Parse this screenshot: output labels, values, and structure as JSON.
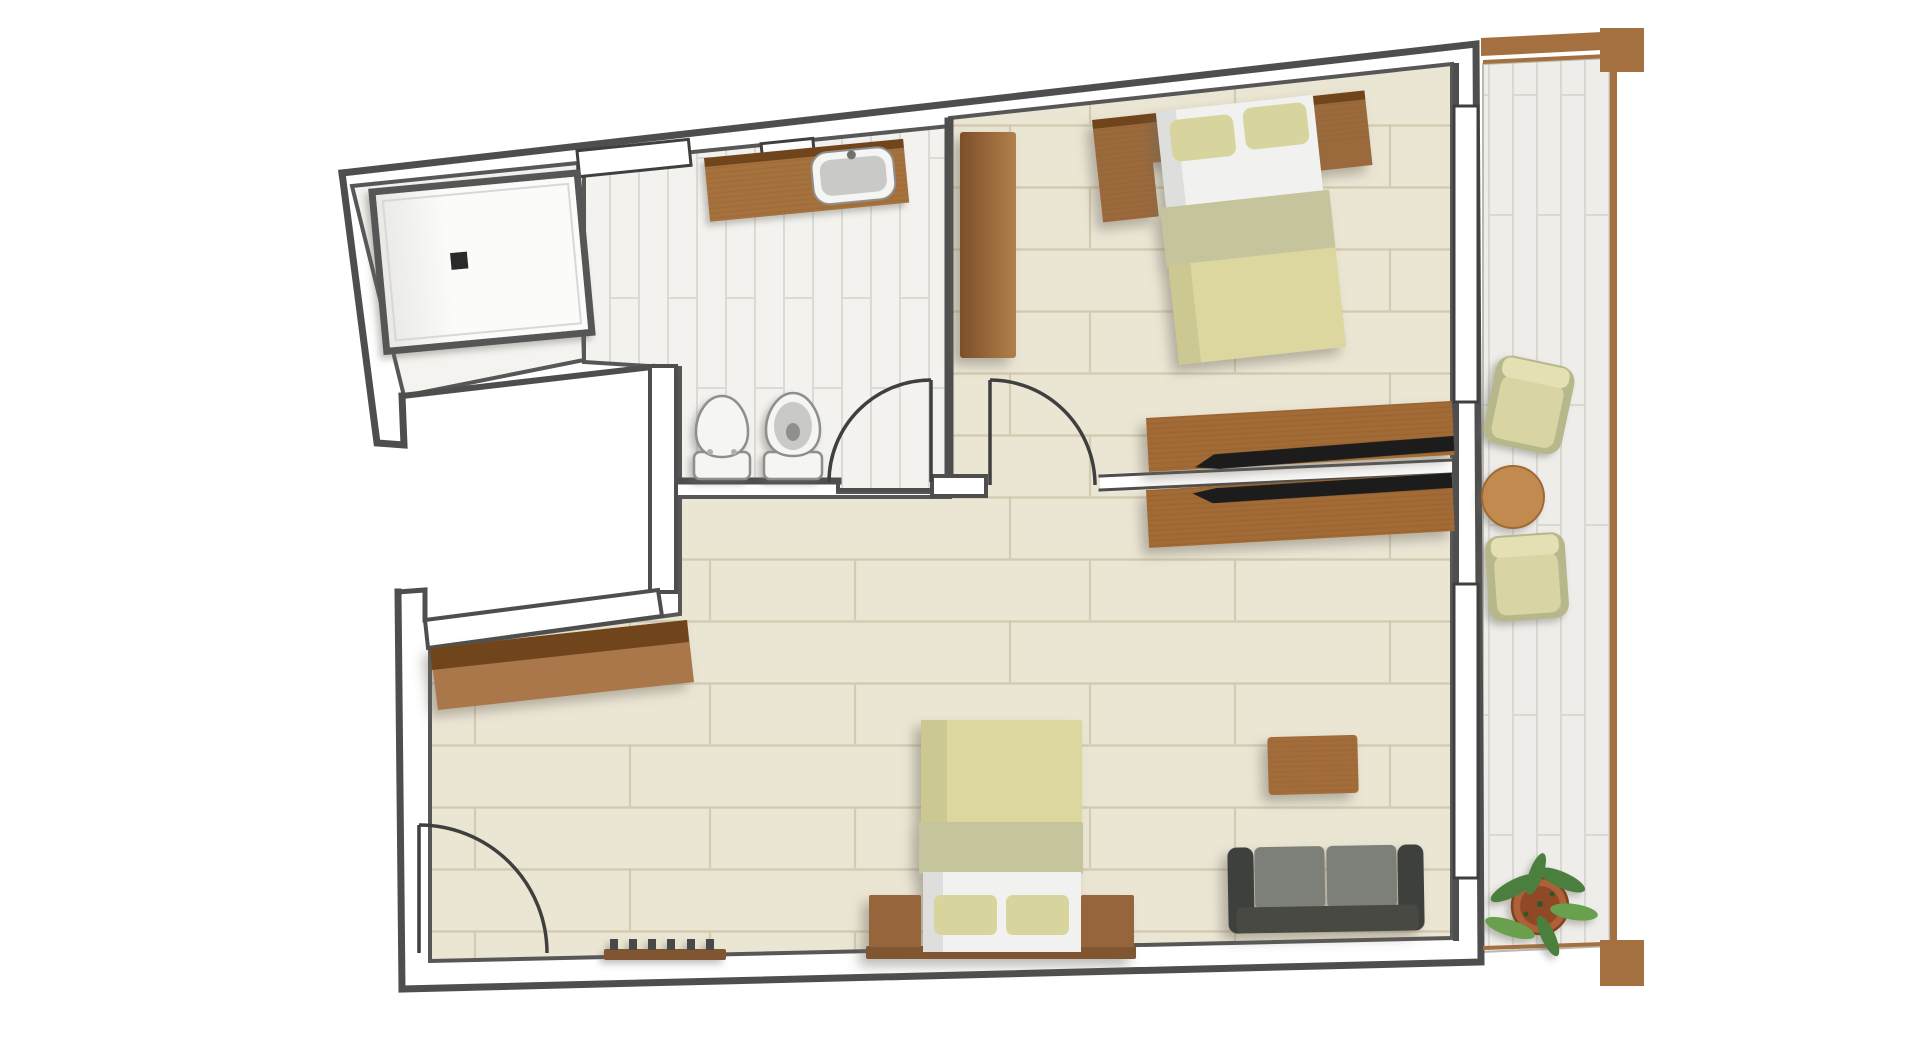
{
  "plan": {
    "kind": "apartment-floor-plan",
    "rooms": [
      {
        "name": "shower-room"
      },
      {
        "name": "bathroom"
      },
      {
        "name": "bedroom"
      },
      {
        "name": "living-room"
      },
      {
        "name": "entry"
      },
      {
        "name": "balcony"
      }
    ],
    "furniture": [
      {
        "name": "walk-in-shower",
        "room": "shower-room"
      },
      {
        "name": "vanity-with-sink",
        "room": "bathroom"
      },
      {
        "name": "toilet",
        "room": "bathroom"
      },
      {
        "name": "bidet",
        "room": "bathroom"
      },
      {
        "name": "wardrobe",
        "room": "bedroom"
      },
      {
        "name": "double-bed",
        "room": "bedroom"
      },
      {
        "name": "headboard-shelf",
        "room": "bedroom"
      },
      {
        "name": "tv-console",
        "room": "bedroom"
      },
      {
        "name": "tv-console",
        "room": "living-room"
      },
      {
        "name": "sofa-bed",
        "room": "living-room"
      },
      {
        "name": "nightstand",
        "room": "living-room"
      },
      {
        "name": "sofa",
        "room": "living-room"
      },
      {
        "name": "coffee-table",
        "room": "living-room"
      },
      {
        "name": "console-desk",
        "room": "entry"
      },
      {
        "name": "shoe-rack",
        "room": "entry"
      },
      {
        "name": "armchair",
        "room": "balcony"
      },
      {
        "name": "armchair",
        "room": "balcony"
      },
      {
        "name": "round-table",
        "room": "balcony"
      },
      {
        "name": "potted-plant",
        "room": "balcony"
      }
    ],
    "openings": [
      {
        "name": "entry-door"
      },
      {
        "name": "bathroom-door"
      },
      {
        "name": "bedroom-door"
      },
      {
        "name": "window-top-wall-large"
      },
      {
        "name": "window-top-wall-small"
      },
      {
        "name": "window-right-wall-upper"
      },
      {
        "name": "window-right-wall-lower"
      },
      {
        "name": "balcony-opening"
      }
    ]
  },
  "palette": {
    "wall": "#4e4e4e",
    "doorLine": "#3f3f3f",
    "innerLine": "#575757",
    "floorBeige": "#ebe6d4",
    "floorBeigeLine": "#d4cbb2",
    "floorShower": "#f4f3f0",
    "tile": "#f3f2ef",
    "tileLine": "#dcdad5",
    "deck": "#eeedea",
    "deckLine": "#d9d8d3",
    "showerWhite": "#fbfbf9",
    "showerShade": "#e9e8e5",
    "drain": "#2c2c2c",
    "fixtureWhite": "#f5f5f3",
    "fixtureGray": "#c9c9c7",
    "fixtureLine": "#8e8e8c",
    "woodDark": "#6f441f",
    "wood": "#9a6a3c",
    "woodMid": "#a5713c",
    "woodCounter": "#a9774a",
    "woodConsole": "#a26b36",
    "woodGrain": "#7d4e24",
    "woodTable": "#a26c3a",
    "woodRound": "#c28a50",
    "woodBalcony": "#a5703f",
    "woodPlatform": "#7f5530",
    "woodSide": "#96653a",
    "wardrobeDark": "#7b4f2a",
    "wardrobeLight": "#b07f4b",
    "linen": "#dbd79f",
    "linenDark": "#c6c49c",
    "linenStrip": "#ccc891",
    "pillow": "#d8d49e",
    "sheet": "#f1f1ef",
    "sheetShade": "#dededc",
    "sofaDark": "#3e413c",
    "sofaBack": "#474a43",
    "sofaCushion": "#7c8078",
    "chairFrame": "#b7b78c",
    "chairSeat": "#d8d4a3",
    "chairBack": "#e4e0b4",
    "tv": "#1f1f1f",
    "potTerra": "#ae6138",
    "potInner": "#8f4a25",
    "potRim": "#7e431f",
    "leaf": "#4c7f3d",
    "leafLight": "#67a04e",
    "white": "#ffffff"
  }
}
